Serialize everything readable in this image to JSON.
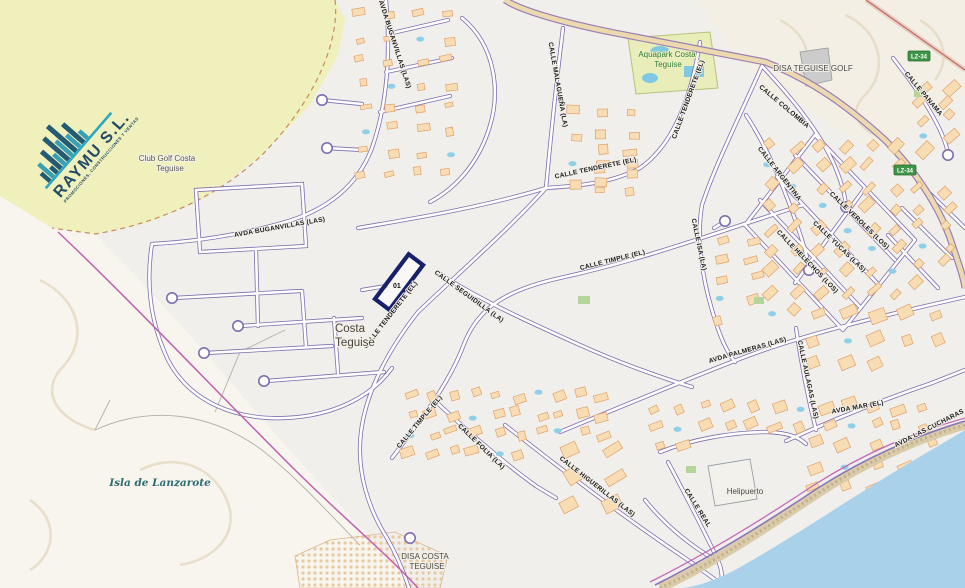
{
  "map": {
    "logo": {
      "name": "RAYMU S.L.",
      "tagline": "PROMOCIONES, CONSTRUCCIONES Y VENTAS"
    },
    "parcel": {
      "id_label": "01"
    },
    "place_labels": [
      {
        "text": "Club Golf Costa",
        "x": 167,
        "y": 161,
        "cls": "place-sm"
      },
      {
        "text": "Teguise",
        "x": 170,
        "y": 171,
        "cls": "place-sm"
      },
      {
        "text": "Aquapark Costa",
        "x": 667,
        "y": 57,
        "cls": "place-green"
      },
      {
        "text": "Teguise",
        "x": 668,
        "y": 67,
        "cls": "place-green"
      },
      {
        "text": "DISA TEGUISE GOLF",
        "x": 813,
        "y": 71,
        "cls": "place-md"
      },
      {
        "text": "Costa",
        "x": 350,
        "y": 332,
        "cls": "place-lg"
      },
      {
        "text": "Teguise",
        "x": 355,
        "y": 346,
        "cls": "place-lg"
      },
      {
        "text": "Isla de Lanzarote",
        "x": 160,
        "y": 486,
        "cls": "island"
      },
      {
        "text": "DISA COSTA",
        "x": 425,
        "y": 559,
        "cls": "place-md"
      },
      {
        "text": "TEGUISE",
        "x": 427,
        "y": 569,
        "cls": "place-md"
      },
      {
        "text": "Helipuerto",
        "x": 745,
        "y": 494,
        "cls": "place-md"
      }
    ],
    "street_labels": [
      {
        "text": "AVDA BUGANVILLAS (LAS)",
        "x": 393,
        "y": 45,
        "rot": 72
      },
      {
        "text": "AVDA BUGANVILLAS (LAS)",
        "x": 280,
        "y": 229,
        "rot": -10
      },
      {
        "text": "CALLE MALAGUEÑA (LA)",
        "x": 556,
        "y": 85,
        "rot": 80
      },
      {
        "text": "CALLE TENDERETE (EL)",
        "x": 690,
        "y": 100,
        "rot": -70
      },
      {
        "text": "CALLE TENDERETE (EL)",
        "x": 596,
        "y": 170,
        "rot": -12
      },
      {
        "text": "CALLE TENDERETE (EL)",
        "x": 392,
        "y": 316,
        "rot": -52
      },
      {
        "text": "CALLE COLOMBIA",
        "x": 783,
        "y": 108,
        "rot": 40
      },
      {
        "text": "CALLE ARGENTINA",
        "x": 778,
        "y": 175,
        "rot": 52
      },
      {
        "text": "CALLE PANAMA",
        "x": 922,
        "y": 95,
        "rot": 50
      },
      {
        "text": "CALLE VEROLES (LOS)",
        "x": 858,
        "y": 222,
        "rot": 44
      },
      {
        "text": "CALLE YUCAS (LAS)",
        "x": 838,
        "y": 248,
        "rot": 44
      },
      {
        "text": "CALLE HELECHOS (LOS)",
        "x": 806,
        "y": 263,
        "rot": 46
      },
      {
        "text": "CALLE SEGUIDILLA (LA)",
        "x": 468,
        "y": 298,
        "rot": 36
      },
      {
        "text": "CALLE TIMPLE (EL)",
        "x": 613,
        "y": 262,
        "rot": -14
      },
      {
        "text": "CALLE ISA (LA)",
        "x": 697,
        "y": 245,
        "rot": 78
      },
      {
        "text": "AVDA PALMERAS (LAS)",
        "x": 748,
        "y": 352,
        "rot": -16
      },
      {
        "text": "CALLE AULAGAS (LAS)",
        "x": 806,
        "y": 380,
        "rot": 78
      },
      {
        "text": "AVDA MAR (EL)",
        "x": 858,
        "y": 409,
        "rot": -10
      },
      {
        "text": "CALLE TIMPLE (EL)",
        "x": 421,
        "y": 423,
        "rot": -50
      },
      {
        "text": "CALLE FOLIA (LA)",
        "x": 480,
        "y": 448,
        "rot": 44
      },
      {
        "text": "CALLE HIGUERILLAS (LAS)",
        "x": 596,
        "y": 488,
        "rot": 38
      },
      {
        "text": "CALLE REAL",
        "x": 696,
        "y": 509,
        "rot": 58
      },
      {
        "text": "AVDA LAS CUCHARAS",
        "x": 930,
        "y": 430,
        "rot": -27
      }
    ],
    "road_badges": [
      {
        "text": "LZ-34",
        "x": 905,
        "y": 170
      },
      {
        "text": "LZ-34",
        "x": 919,
        "y": 56
      }
    ],
    "colors": {
      "sea": "#a9d2ea",
      "golf": "#eff0bc",
      "aquapark": "#e9edba",
      "building": "#f7dcb4",
      "building_outline": "#dfa269",
      "street_casing": "#7f6db0",
      "main_road": "#ecd9ae",
      "parcel_outline": "#16206b",
      "boundary": "#c060b0",
      "badge_green": "#3f9447",
      "logo_teal": "#2ea8c0",
      "logo_navy": "#224b66",
      "pool": "#8fd0e8"
    }
  }
}
